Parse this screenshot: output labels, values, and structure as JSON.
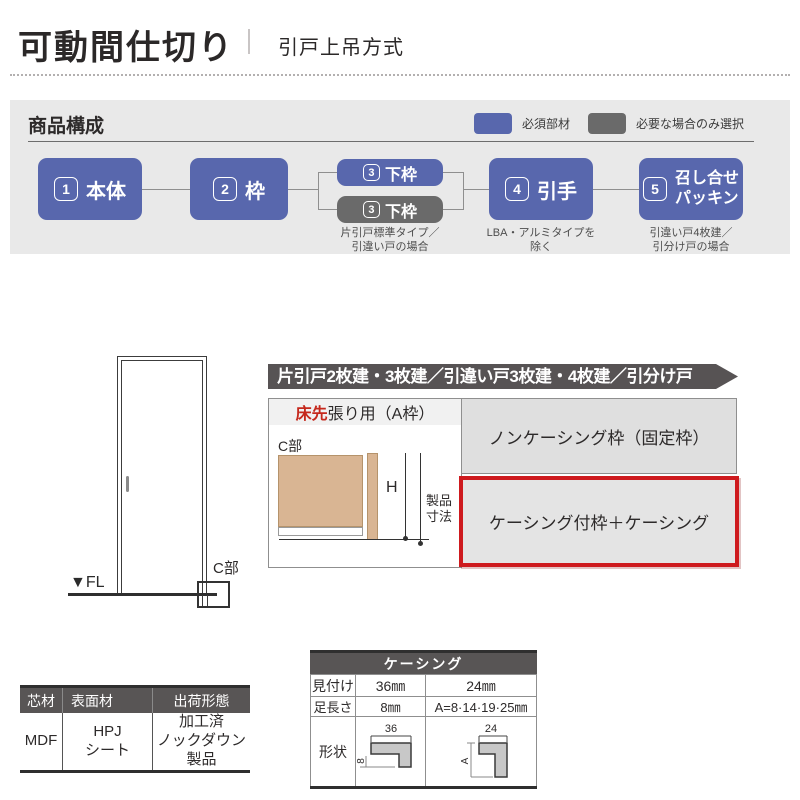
{
  "header": {
    "title": "可動間仕切り",
    "subtitle": "引戸上吊方式"
  },
  "composition": {
    "title": "商品構成",
    "legend": {
      "required": "必須部材",
      "optional": "必要な場合のみ選択"
    },
    "colors": {
      "required_blue": "#5867ad",
      "optional_gray": "#6a6a6a"
    },
    "boxes": {
      "b1": {
        "num": "1",
        "label": "本体"
      },
      "b2": {
        "num": "2",
        "label": "枠"
      },
      "b3a": {
        "num": "3",
        "label": "下枠"
      },
      "b3b": {
        "num": "3",
        "label": "下枠",
        "note": "片引戸標準タイプ／\n引違い戸の場合"
      },
      "b4": {
        "num": "4",
        "label": "引手",
        "note": "LBA・アルミタイプを\n除く"
      },
      "b5": {
        "num": "5",
        "label": "召し合せ\nパッキン",
        "note": "引違い戸4枚建／\n引分け戸の場合"
      }
    }
  },
  "door_diagram": {
    "fl_label": "▼FL",
    "c_label": "C部"
  },
  "frame_section": {
    "banner": "片引戸2枚建・3枚建／引違い戸3枚建・4枚建／引分け戸",
    "header_red": "床先",
    "header_rest": "張り用（A枠）",
    "detail_label": "C部",
    "height_label": "H",
    "product_dim_label": "製品\n寸法",
    "option_noncasing": "ノンケーシング枠（固定枠）",
    "option_casing": "ケーシング付枠＋ケーシング",
    "highlight_color": "#ce1a1e"
  },
  "material_table": {
    "h_core": "芯材",
    "h_surface": "表面材",
    "h_ship": "出荷形態",
    "core": "MDF",
    "surface": "HPJ\nシート",
    "ship": "加工済\nノックダウン\n製品"
  },
  "casing_table": {
    "title": "ケーシング",
    "r1_label": "見付け",
    "r1_c1": "36㎜",
    "r1_c2": "24㎜",
    "r2_label": "足長さ",
    "r2_c1": "8㎜",
    "r2_c2": "A=8·14·19·25㎜",
    "r3_label": "形状",
    "shape36_dim": "36",
    "shape36_side": "8",
    "shape24_dim": "24",
    "shape24_side": "A"
  }
}
